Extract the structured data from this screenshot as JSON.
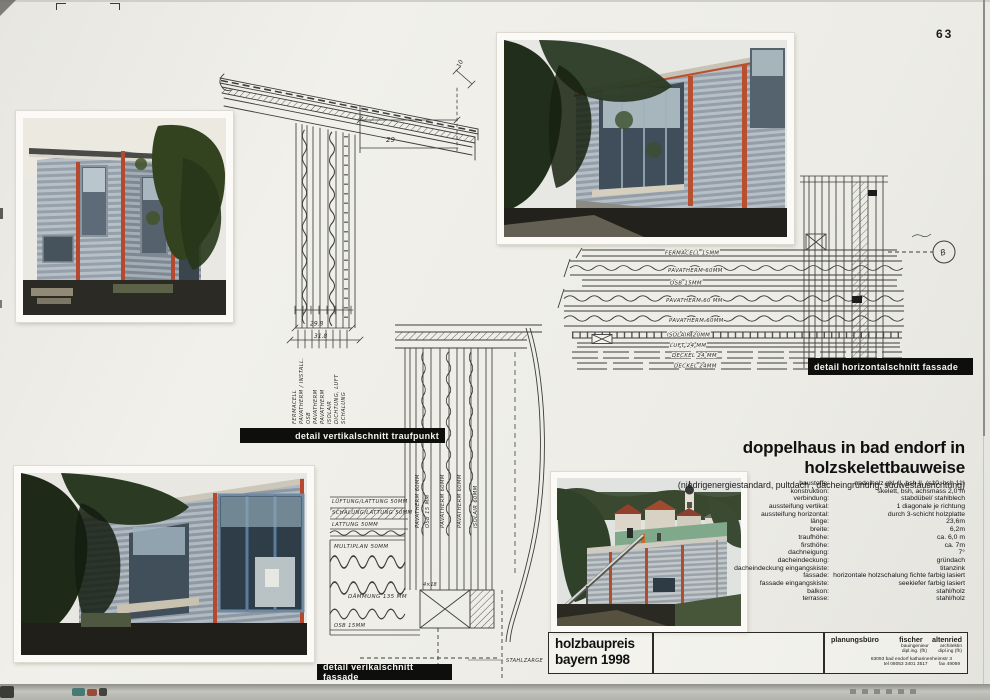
{
  "page": {
    "number": "63"
  },
  "title_block": {
    "title": "doppelhaus in bad endorf in holzskelettbauweise",
    "subtitle": "(niedrigenergiestandard, pultdach , dacheingrünung, südwestausrichtung)"
  },
  "specs": {
    "rows": [
      {
        "label": "baustoffe:",
        "value": "nadelholz gkl. II, bsh II, (s10, bsh 11)"
      },
      {
        "label": "konstruktion:",
        "value": "skelett, bsh,  achsmass 2,0 m"
      },
      {
        "label": "verbindung:",
        "value": "stabdübel/ stahlblech"
      },
      {
        "label": "aussteifung vertikal:",
        "value": "1 diagonale je richtung"
      },
      {
        "label": "aussteifung horizontal:",
        "value": "durch 3-schicht holzplatte"
      },
      {
        "label": "länge:",
        "value": "23,6m"
      },
      {
        "label": "breite:",
        "value": "6,2m"
      },
      {
        "label": "traufhöhe:",
        "value": "ca. 6,0 m"
      },
      {
        "label": "firsthöhe:",
        "value": "ca. 7m"
      },
      {
        "label": "dachneigung:",
        "value": "7°"
      },
      {
        "label": "dacheindeckung:",
        "value": "gründach"
      },
      {
        "label": "dacheindeckung eingangskiste:",
        "value": "titanzink"
      },
      {
        "label": "fassade:",
        "value": "horizontale holzschalung fichte farbig lasiert"
      },
      {
        "label": "fassade eingangskiste:",
        "value": "seekiefer farbig lasiert"
      },
      {
        "label": "balkon:",
        "value": "stahl/holz"
      },
      {
        "label": "terrasse:",
        "value": "stahl/holz"
      }
    ]
  },
  "labels": {
    "traufpunkt": "detail vertikalschnitt traufpunkt",
    "vertikal_fassade": "detail verikalschnitt fassade",
    "horizontal_fassade": "detail horizontalschnitt fassade"
  },
  "award": {
    "line1": "holzbaupreis",
    "line2": "bayern 1998"
  },
  "firm": {
    "role_title": "planungsbüro",
    "name1": "fischer",
    "name2": "altenried",
    "prof1": "bauingenieur",
    "prof2": "architektin",
    "deg1": "dipl.ing. (fh)",
    "deg2": "dipl.ing (fh)",
    "address": "83093 bad endorf  katharinenheimstr 3",
    "tel": "tel  08053 3401 3517",
    "fax": "fax  49069"
  },
  "drawings": {
    "traufpunkt": {
      "dim_roof_overhang": "10",
      "dim_width": "29",
      "dim_lower1": "29.8",
      "dim_lower2": "31.8",
      "layers": [
        "fermacell",
        "pavatherm / install.",
        "osb",
        "pavatherm",
        "pavatherm",
        "isolair",
        "dichtung, luft",
        "schalung"
      ]
    },
    "vertikalschnitt": {
      "left_labels": [
        "lüftung/lattung 50mm",
        "schalung/lattung 50mm",
        "lattung 50mm",
        "multiplan 50mm",
        "dämmung 135 mm",
        "osb 15mm"
      ],
      "wall_layers": [
        "pavatherm 60mm",
        "osb 15 mm",
        "pavatherm 60mm",
        "pavatherm 60mm",
        "isolair 60mm"
      ],
      "dim_box": "4×18",
      "note": "stahlzarge"
    },
    "horizontalschnitt": {
      "layers": [
        "fermacell 15mm",
        "pavatherm 60mm",
        "osb 15mm",
        "pavatherm 60 mm",
        "pavatherm 60mm",
        "isolair 20mm",
        "luft 24 mm",
        "deckel 24 mm",
        "deckel 24mm"
      ],
      "section_marker": "B"
    }
  }
}
